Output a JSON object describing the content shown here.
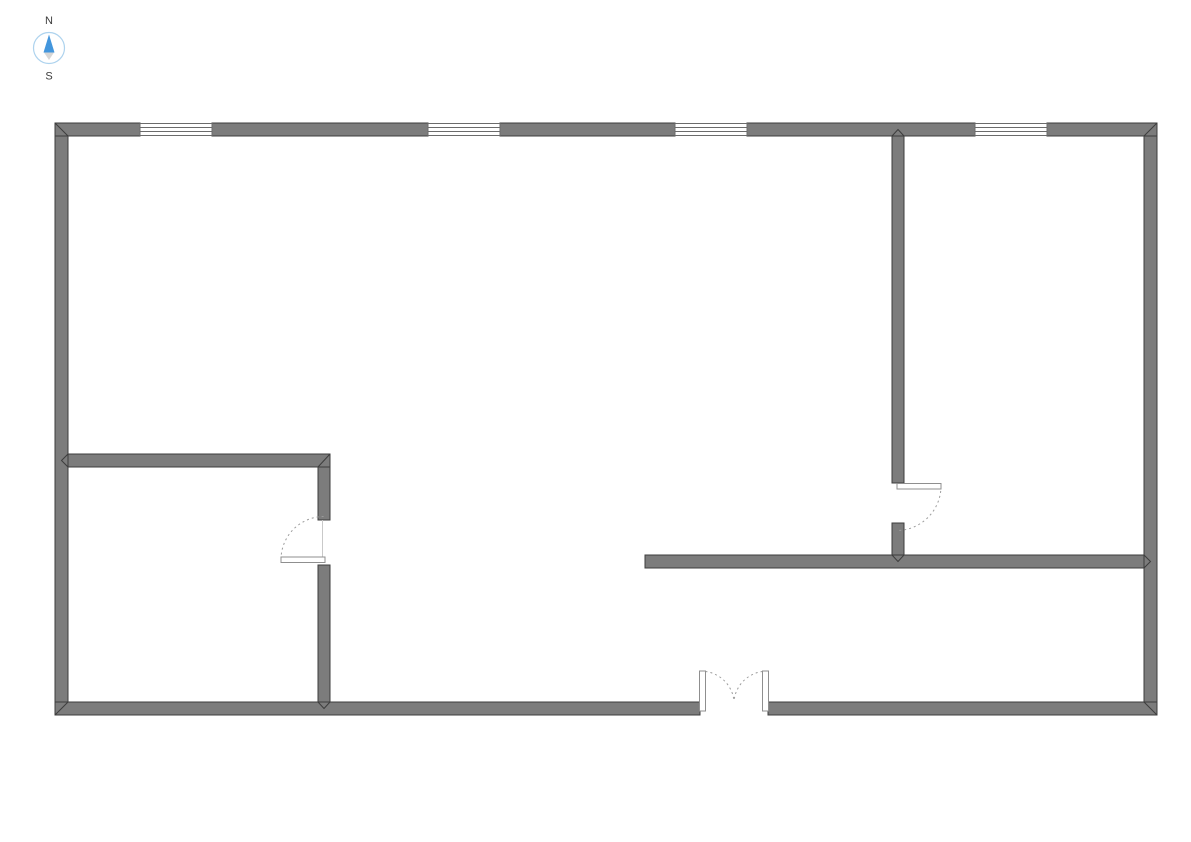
{
  "canvas": {
    "width": 1191,
    "height": 842,
    "background": "#ffffff"
  },
  "compass": {
    "north_label": "N",
    "south_label": "S",
    "ring_color": "#aed3ee",
    "north_color": "#4396dd",
    "south_color": "#d6d6d6",
    "label_color": "#3c3c3c"
  },
  "floor_plan": {
    "colors": {
      "wall_fill": "#7c7c7c",
      "wall_stroke": "#3d3d3d",
      "window_stroke": "#6b6b6b",
      "door_arc": "#9c9c9c",
      "door_leaf_fill": "#ffffff",
      "door_leaf_stroke": "#8f8f8f",
      "door_frame": "#c9c9c9",
      "floor_fill": "#ffffff"
    },
    "wall_thickness": 13,
    "walls": [
      {
        "name": "exterior-wall-left",
        "x": 55,
        "y": 123,
        "w": 13,
        "h": 592
      },
      {
        "name": "exterior-wall-right",
        "x": 1144,
        "y": 123,
        "w": 13,
        "h": 592
      },
      {
        "name": "exterior-wall-top-segment-1",
        "x": 55,
        "y": 123,
        "w": 85,
        "h": 13
      },
      {
        "name": "exterior-wall-top-segment-2",
        "x": 212,
        "y": 123,
        "w": 216,
        "h": 13
      },
      {
        "name": "exterior-wall-top-segment-3",
        "x": 500,
        "y": 123,
        "w": 175,
        "h": 13
      },
      {
        "name": "exterior-wall-top-segment-4",
        "x": 747,
        "y": 123,
        "w": 228,
        "h": 13
      },
      {
        "name": "exterior-wall-top-segment-5",
        "x": 1047,
        "y": 123,
        "w": 110,
        "h": 13
      },
      {
        "name": "exterior-wall-bottom-segment-left",
        "x": 55,
        "y": 702,
        "w": 645,
        "h": 13
      },
      {
        "name": "exterior-wall-bottom-segment-right",
        "x": 768,
        "y": 702,
        "w": 389,
        "h": 13
      },
      {
        "name": "interior-wall-vertical-upper",
        "x": 892,
        "y": 136,
        "w": 12,
        "h": 347
      },
      {
        "name": "interior-wall-vertical-lower",
        "x": 892,
        "y": 523,
        "w": 12,
        "h": 32
      },
      {
        "name": "interior-wall-horizontal",
        "x": 645,
        "y": 555,
        "w": 499,
        "h": 13
      },
      {
        "name": "room-wall-east-upper",
        "x": 318,
        "y": 454,
        "w": 12,
        "h": 66
      },
      {
        "name": "room-wall-top",
        "x": 68,
        "y": 454,
        "w": 262,
        "h": 13
      },
      {
        "name": "room-wall-east-lower",
        "x": 318,
        "y": 565,
        "w": 12,
        "h": 137
      }
    ],
    "windows": [
      {
        "x": 140,
        "y": 123.5,
        "w": 72,
        "h": 12,
        "lines": [
          127.5,
          131.5
        ]
      },
      {
        "x": 428,
        "y": 123.5,
        "w": 72,
        "h": 12,
        "lines": [
          127.5,
          131.5
        ]
      },
      {
        "x": 675,
        "y": 123.5,
        "w": 72,
        "h": 12,
        "lines": [
          127.5,
          131.5
        ]
      },
      {
        "x": 975,
        "y": 123.5,
        "w": 72,
        "h": 12,
        "lines": [
          127.5,
          131.5
        ]
      }
    ],
    "doors": [
      {
        "name": "room-door",
        "leaves": [
          {
            "x": 281,
            "y": 557,
            "w": 44,
            "h": 5.5
          }
        ],
        "arcs": [
          "M 281 559.5 A 43 43 0 0 1 324 516.5"
        ],
        "jambs": [
          {
            "x1": 322.5,
            "y1": 520,
            "x2": 322.5,
            "y2": 557
          }
        ]
      },
      {
        "name": "interior-door",
        "leaves": [
          {
            "x": 897,
            "y": 483.5,
            "w": 44,
            "h": 5.5
          }
        ],
        "arcs": [
          "M 941 486 A 44.5 44.5 0 0 1 896.5 530.5"
        ],
        "jambs": []
      },
      {
        "name": "entrance-double-door",
        "leaves": [
          {
            "x": 699.5,
            "y": 671,
            "w": 6,
            "h": 40
          },
          {
            "x": 762.5,
            "y": 671,
            "w": 6,
            "h": 40
          }
        ],
        "arcs": [
          "M 705.5 671.5 A 33 33 0 0 1 734 701",
          "M 762.5 671.5 A 33 33 0 0 0 734 701"
        ],
        "jambs": []
      }
    ],
    "miters": [
      {
        "name": "corner-top-left",
        "points": "55,123 68,136"
      },
      {
        "name": "corner-top-right",
        "points": "1157,123 1144,136"
      },
      {
        "name": "corner-bottom-left",
        "points": "55,715 68,702"
      },
      {
        "name": "corner-bottom-right",
        "points": "1157,715 1144,702"
      },
      {
        "name": "joint-top-interior-wall",
        "points": "892,136 898,129.5 904,136"
      },
      {
        "name": "joint-right-interior-wall",
        "points": "1144,555 1150.5,561.5 1144,568"
      },
      {
        "name": "joint-left-room-wall",
        "points": "68,454 61.5,460.5 68,467"
      },
      {
        "name": "joint-bottom-room-wall",
        "points": "318,702 324,708.5 330,702"
      },
      {
        "name": "joint-interior-wall-cross",
        "points": "892,555 898,561.5 904,555"
      },
      {
        "name": "corner-room-northeast",
        "points": "330,454 318,467"
      }
    ]
  }
}
